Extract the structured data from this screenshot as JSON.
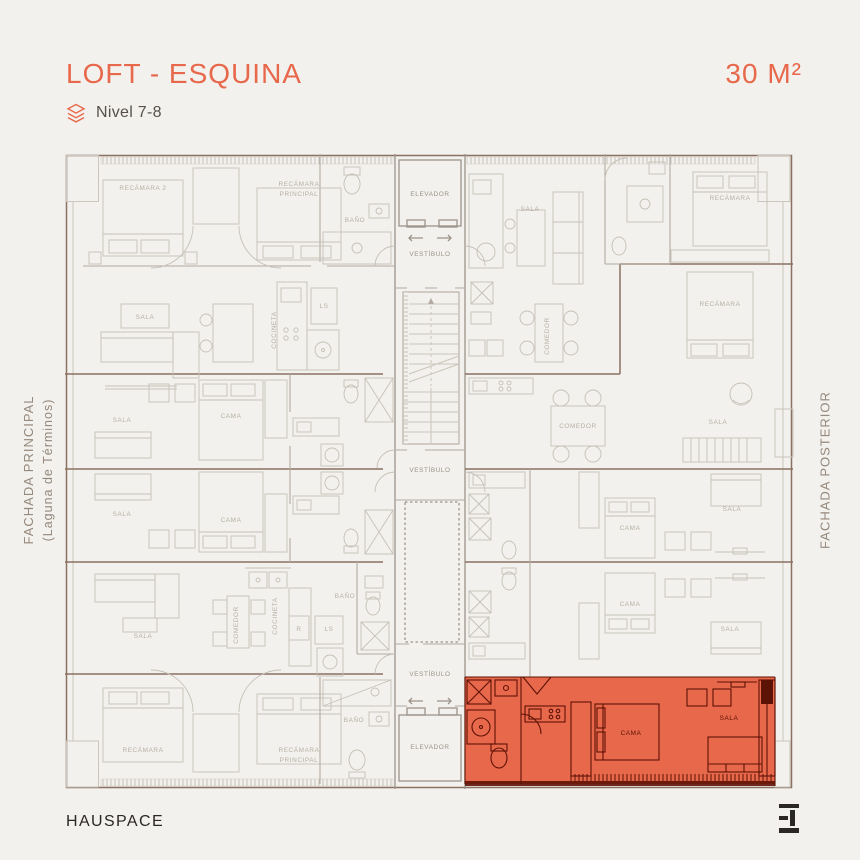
{
  "header": {
    "title": "LOFT - ESQUINA",
    "area": "30 M²",
    "level_label": "Nivel 7-8"
  },
  "facades": {
    "left_line1": "FACHADA PRINCIPAL",
    "left_line2": "(Laguna de Términos)",
    "right": "FACHADA POSTERIOR"
  },
  "footer": {
    "brand": "HAUSPACE"
  },
  "icons": {
    "level": "layers-icon",
    "logo": "hauspace-h-logo"
  },
  "colors": {
    "bg": "#F2F1ED",
    "accent": "#E8684B",
    "dark": "#2B2724",
    "level": "#57504A",
    "facade": "#95887C",
    "line": "#CBC5BC",
    "line2": "#B3ABA1",
    "wall": "#9C948A",
    "bnd": "#8A7162",
    "lbl": "#B7AFA4",
    "lblcore": "#9A9288",
    "odark": "#5D1206",
    "unit_fill": "#E8684B"
  },
  "plan": {
    "highlighted_unit": "LOFT - ESQUINA (30 m², bottom right, orange)",
    "labels": [
      {
        "t": "ELEVADOR",
        "x": 365,
        "y": 42,
        "tone": "core"
      },
      {
        "t": "VESTÍBULO",
        "x": 365,
        "y": 102,
        "tone": "core"
      },
      {
        "t": "VESTÍBULO",
        "x": 365,
        "y": 318,
        "tone": "core"
      },
      {
        "t": "VESTÍBULO",
        "x": 365,
        "y": 522,
        "tone": "core"
      },
      {
        "t": "ELEVADOR",
        "x": 365,
        "y": 595,
        "tone": "core"
      },
      {
        "t": "RECÁMARA 2",
        "x": 78,
        "y": 36
      },
      {
        "t": "RECÁMARA",
        "x": 234,
        "y": 32
      },
      {
        "t": "PRINCIPAL",
        "x": 234,
        "y": 42
      },
      {
        "t": "BAÑO",
        "x": 290,
        "y": 68
      },
      {
        "t": "SALA",
        "x": 80,
        "y": 165
      },
      {
        "t": "COCINETA",
        "x": 211,
        "y": 176,
        "v": true
      },
      {
        "t": "LS",
        "x": 259,
        "y": 154
      },
      {
        "t": "SALA",
        "x": 57,
        "y": 268
      },
      {
        "t": "CAMA",
        "x": 166,
        "y": 264
      },
      {
        "t": "SALA",
        "x": 57,
        "y": 362
      },
      {
        "t": "CAMA",
        "x": 166,
        "y": 368
      },
      {
        "t": "SALA",
        "x": 78,
        "y": 484
      },
      {
        "t": "COMEDOR",
        "x": 173,
        "y": 471,
        "v": true
      },
      {
        "t": "COCINETA",
        "x": 212,
        "y": 462,
        "v": true
      },
      {
        "t": "R",
        "x": 234,
        "y": 477
      },
      {
        "t": "LS",
        "x": 264,
        "y": 477
      },
      {
        "t": "BAÑO",
        "x": 280,
        "y": 444
      },
      {
        "t": "RECÁMARA",
        "x": 78,
        "y": 598
      },
      {
        "t": "RECÁMARA",
        "x": 234,
        "y": 598
      },
      {
        "t": "PRINCIPAL",
        "x": 234,
        "y": 608
      },
      {
        "t": "BAÑO",
        "x": 289,
        "y": 568
      },
      {
        "t": "SALA",
        "x": 465,
        "y": 57
      },
      {
        "t": "RECÁMARA",
        "x": 665,
        "y": 46
      },
      {
        "t": "RECÁMARA",
        "x": 655,
        "y": 152
      },
      {
        "t": "COMEDOR",
        "x": 484,
        "y": 182,
        "v": true
      },
      {
        "t": "COMEDOR",
        "x": 513,
        "y": 274
      },
      {
        "t": "SALA",
        "x": 653,
        "y": 270
      },
      {
        "t": "SALA",
        "x": 667,
        "y": 357
      },
      {
        "t": "CAMA",
        "x": 565,
        "y": 376
      },
      {
        "t": "CAMA",
        "x": 565,
        "y": 452
      },
      {
        "t": "SALA",
        "x": 665,
        "y": 477
      },
      {
        "t": "CAMA",
        "x": 566,
        "y": 581,
        "tone": "dark"
      },
      {
        "t": "SALA",
        "x": 664,
        "y": 566,
        "tone": "dark"
      }
    ]
  }
}
